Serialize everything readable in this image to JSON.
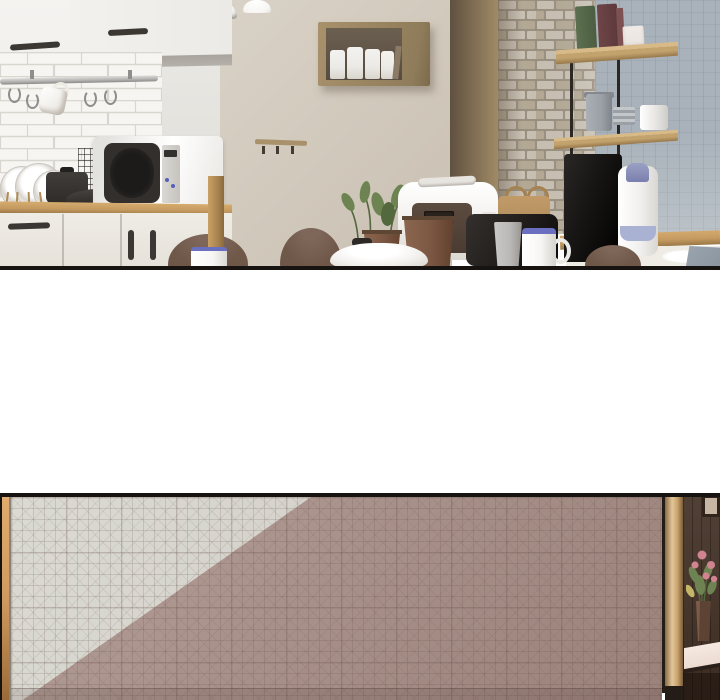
{
  "meta": {
    "content_type": "webtoon-comic-strip",
    "panel_count": 2,
    "text_content": "none"
  },
  "palette": {
    "paper": "#ffffff",
    "outline": "#161310",
    "wall_left": "#ebeae6",
    "wall_left_shade": "#dddbd5",
    "cabinet_white": "#f2f1ee",
    "cabinet_underside": "#b5b1aa",
    "handle_dark": "#3b3733",
    "tile": "#f6f5f1",
    "tile_line": "#d9d5cf",
    "rail_metal": "#b9b8b6",
    "rail_dark": "#8f8e8c",
    "wall_beige": "#d9d2c6",
    "wall_beige_deep": "#c9c0b2",
    "wood_box": "#a8916b",
    "box_interior": "#564c40",
    "jar_white": "#eceae6",
    "brown_wall": "#5f5040",
    "brown_wall_light": "#a38d68",
    "brick": "#c8c0b3",
    "brick_dark": "#b3a995",
    "brick_mortar": "#9a9081",
    "wall_blue": "#a9b2ba",
    "shelf_wood": "#c2a26d",
    "shelf_wood_dark": "#97784a",
    "shelf_rod": "#2b2724",
    "book_green": "#5d7050",
    "book_red": "#6e4547",
    "box_white": "#e9e4e0",
    "canister_gray": "#9aa0a6",
    "canister_white": "#e6e4e1",
    "machine_black": "#181615",
    "thermos_white": "#f1f0ee",
    "thermos_blue": "#7a80ad",
    "thermos_band": "#aab2d4",
    "counter_wood": "#c49a60",
    "counter_wood_dark": "#9a7846",
    "cabinet_cream": "#efece6",
    "microwave_body": "#f2f1ef",
    "microwave_door": "#332f2d",
    "button_blue": "#5560b8",
    "pot_black": "#2e2b29",
    "plate_white": "#fbfaf8",
    "plate_ring": "#d8d5cf",
    "rack_wood": "#b08b55",
    "chair_brown": "#6e5748",
    "mug_white": "#f7f6f4",
    "mug_blue": "#6a6fc0",
    "casserole_white": "#f3f1ee",
    "terracotta": "#7b5742",
    "plant_green": "#6d8452",
    "plant_green_dark": "#54683e",
    "cooker_white": "#f1efec",
    "cooker_panel": "#4a3c33",
    "toaster_black": "#211e1c",
    "bag_tan": "#b08d5e",
    "cup_gray": "#b9b7b6",
    "dish_gray": "#8a95a0",
    "lamp_white": "#f4f2ef",
    "corner_gray": "#8f8e8c",
    "p2_light": "#d3d1c9",
    "p2_dark": "#a8918a",
    "p2_dark_deep": "#9b837b",
    "p2_wood_strip": "#cf9a5f",
    "trim_light": "#e2c69b",
    "trim_mid": "#c9a269",
    "trim_dark": "#7a5c3c",
    "door_wood": "#463428",
    "frame_inner": "#c8b6a4",
    "flower_pink": "#cf8490",
    "leaf_yellow": "#c5b568",
    "vase_brown": "#5d4333",
    "sill_white": "#ead9cf"
  },
  "scene": {
    "panel1": {
      "label": "kitchen-interior",
      "objects": [
        "pendant-lamps",
        "upper-cabinets",
        "subway-tile-backsplash",
        "hanging-rail-with-hooks",
        "hanging-mug",
        "dish-rack-with-plates",
        "black-pot",
        "frying-pan",
        "wire-grid-panel",
        "microwave",
        "wooden-counter",
        "base-cabinets",
        "beige-wall",
        "wall-box-shelf-with-jars",
        "wall-hook-rail",
        "brown-wall-panel",
        "brick-pillar",
        "wall-mounted-shelves",
        "books",
        "storage-canisters",
        "coffee-machine",
        "thermos",
        "blue-gray-tiled-wall",
        "right-counter",
        "dining-chairs",
        "white-mugs",
        "white-casserole",
        "rice-cooker",
        "potted-plants",
        "toaster",
        "wooden-basket",
        "gray-cup",
        "white-dish"
      ]
    },
    "gap": {
      "label": "white-spacer-between-panels"
    },
    "panel2": {
      "label": "lattice-pattern-wall-with-doorway",
      "objects": [
        "left-wood-jamb",
        "grid-pattern-wallpaper",
        "diagonal-light-shading",
        "wood-door-trim",
        "dark-wood-hallway",
        "picture-frame",
        "flower-arrangement",
        "vase",
        "console-sill"
      ]
    }
  }
}
